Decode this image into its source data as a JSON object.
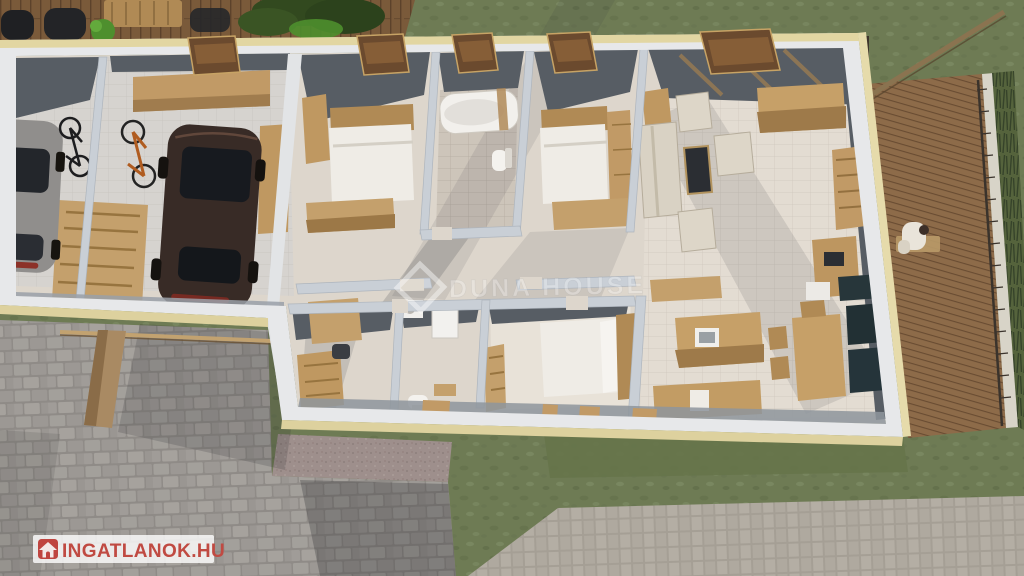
{
  "scene_kind": "3d-floorplan-render",
  "watermarks": {
    "agency_center": {
      "text": "DUNA HOUSE",
      "logo": "diamond-icon",
      "color": "#ffffff",
      "opacity": 0.45
    },
    "portal_corner": {
      "text": "INGATLANOK.HU",
      "icon": "house-icon",
      "text_color": "#c04a42",
      "bar_color": "#ffffff"
    }
  },
  "palette": {
    "grass": "#6e7b54",
    "deck_wood": "#7a5a3a",
    "terrace_wood": "#8d6b49",
    "driveway_cobble": "#9d9995",
    "sidewalk": "#b2aca2",
    "gravel_strip": "#9e8f8c",
    "wall_white": "#e7e8ea",
    "wall_top_edge": "#e2d6a2",
    "wall_inner_dark": "#575d64",
    "interior_wall": "#c9cfd6",
    "floor": "#ddd6cc",
    "furniture_wood": "#c19a66",
    "car_brown": "#382b26",
    "car_gray": "#908e8c",
    "cabinet_teal": "#27363a",
    "bike_orange": "#b05c20",
    "plant_green": "#4e8f2e"
  }
}
